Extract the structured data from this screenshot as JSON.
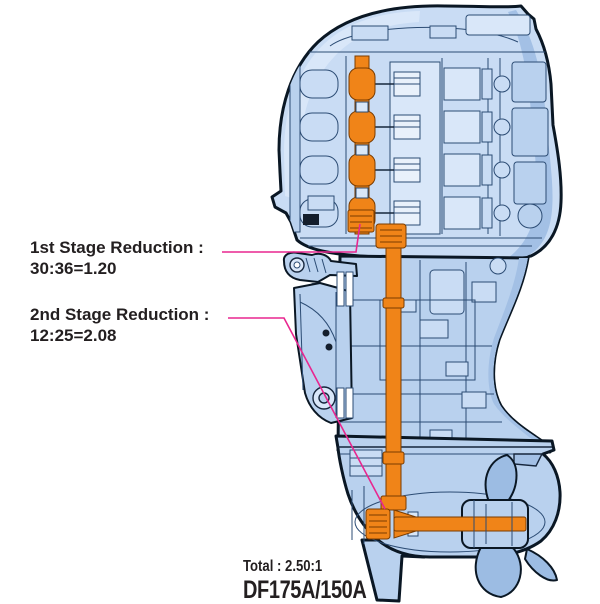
{
  "page": {
    "background": "#ffffff"
  },
  "colors": {
    "orange": "#F08418",
    "orange_outline": "#7A3C00",
    "pink": "#E8268F",
    "blue_light": "#C9DCF4",
    "blue_mid": "#B9D1EE",
    "blue_shade": "#A3C0E5",
    "line_blue": "#2C4C74",
    "outline_navy": "#0A1724",
    "text": "#231F20"
  },
  "annotations": {
    "first_stage": {
      "title": "1st Stage Reduction :",
      "value": "30:36=1.20"
    },
    "second_stage": {
      "title": "2nd Stage Reduction :",
      "value": "12:25=2.08"
    }
  },
  "footer": {
    "total": "Total : 2.50:1",
    "model": "DF175A/150A"
  }
}
